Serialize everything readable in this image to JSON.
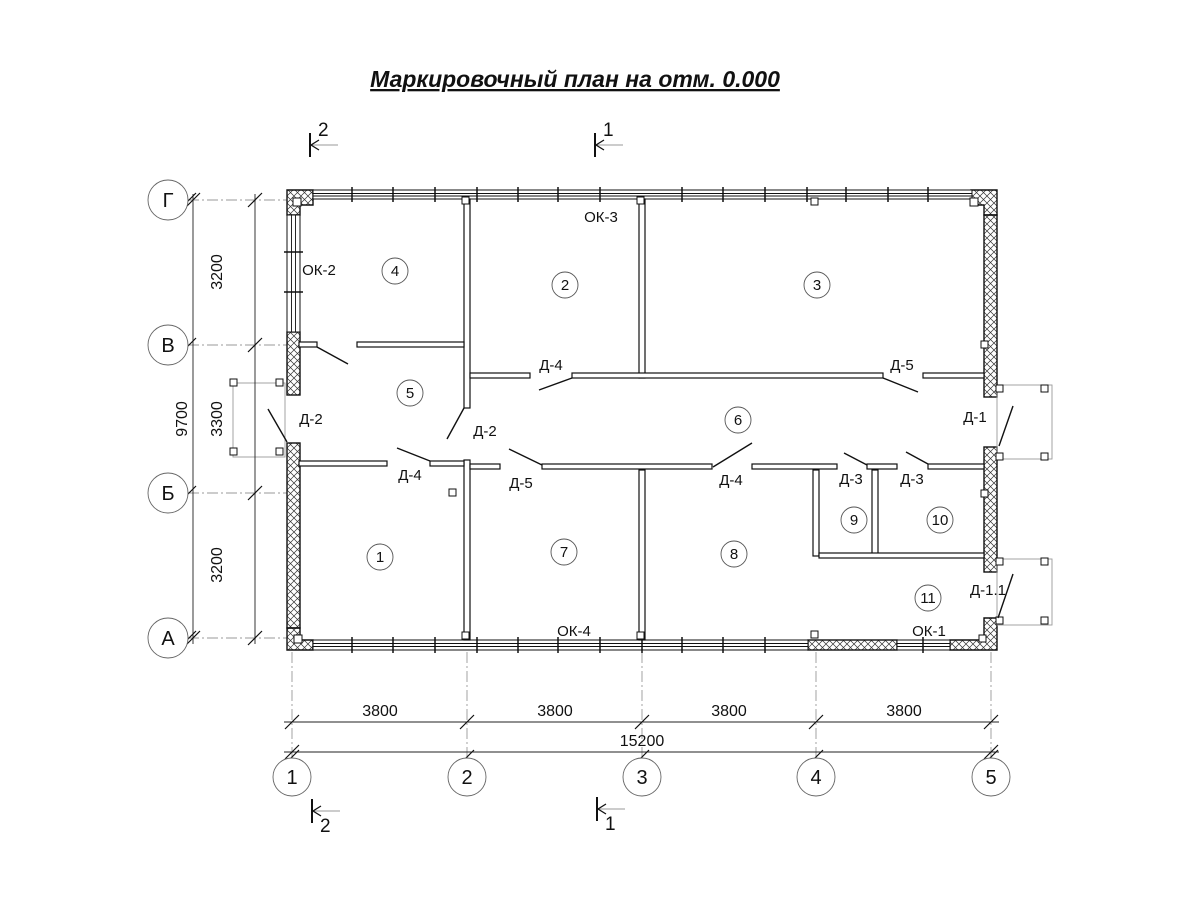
{
  "title": "Маркировочный план на отм. 0.000",
  "axes": {
    "rows": [
      {
        "label": "Г"
      },
      {
        "label": "В"
      },
      {
        "label": "Б"
      },
      {
        "label": "А"
      }
    ],
    "columns": [
      {
        "label": "1"
      },
      {
        "label": "2"
      },
      {
        "label": "3"
      },
      {
        "label": "4"
      },
      {
        "label": "5"
      }
    ]
  },
  "dimensions": {
    "row_spans": [
      "3200",
      "3300",
      "3200"
    ],
    "row_total": "9700",
    "col_spans": [
      "3800",
      "3800",
      "3800",
      "3800"
    ],
    "col_total": "15200"
  },
  "rooms": [
    "1",
    "2",
    "3",
    "4",
    "5",
    "6",
    "7",
    "8",
    "9",
    "10",
    "11"
  ],
  "windows": {
    "ok1": "ОК-1",
    "ok2": "ОК-2",
    "ok3": "ОК-3",
    "ok4": "ОК-4"
  },
  "doors": {
    "d2_entry": "Д-2",
    "d2_inner": "Д-2",
    "d4_top": "Д-4",
    "d5_top": "Д-5",
    "d1": "Д-1",
    "d1_1": "Д-1.1",
    "d5_mid": "Д-5",
    "d4_mid": "Д-4",
    "d3_a": "Д-3",
    "d3_b": "Д-3",
    "d4_room1": "Д-4"
  },
  "section_markers": {
    "top_left": "2",
    "top_center": "1",
    "bottom_left": "2",
    "bottom_center": "1"
  },
  "colors": {
    "line": "#111111",
    "axis_gray": "#999999",
    "background": "#ffffff"
  }
}
